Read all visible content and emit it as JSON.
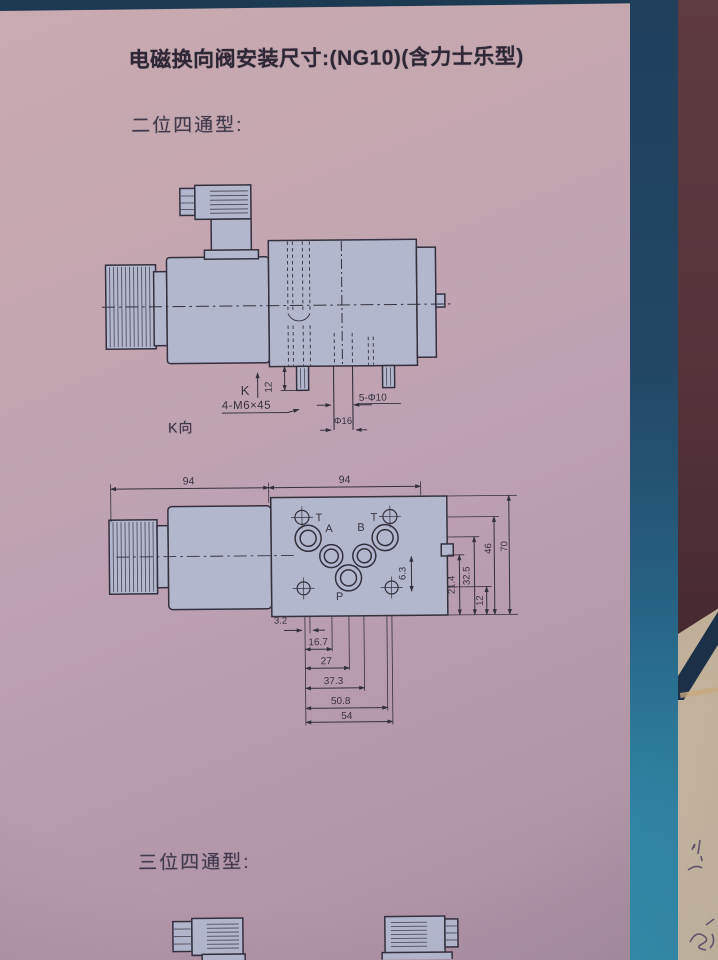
{
  "title": "电磁换向阀安装尺寸:(NG10)(含力士乐型)",
  "section_two_position": "二位四通型:",
  "section_three_position": "三位四通型:",
  "side_view": {
    "view_ref_label": "K向",
    "dims": {
      "k": "K",
      "offset_12": "12",
      "mounting_bolts": "4-M6×45",
      "locating_pins": "5-Φ10",
      "center_hole": "Φ16"
    }
  },
  "top_view": {
    "ports": {
      "t_left": "T",
      "t_right": "T",
      "a": "A",
      "b": "B",
      "p": "P"
    },
    "dims": {
      "width_left": "94",
      "width_right": "94",
      "h_3_2": "3.2",
      "h_16_7": "16.7",
      "h_27": "27",
      "h_37_3": "37.3",
      "h_50_8": "50.8",
      "h_54": "54",
      "v_6_3": "6.3",
      "v_12": "12",
      "v_21_4": "21.4",
      "v_32_5": "32.5",
      "v_46": "46",
      "v_70": "70"
    }
  },
  "colors": {
    "page_pink": "#bda0b2",
    "drawing_fill": "#b3b7cd",
    "drawing_line": "#34303e",
    "top_strip_navy": "#1c3a52",
    "side_strip_teal": "#2f84a4",
    "side_paper_beige": "#c2b098",
    "side_cover_brown": "#57343b"
  }
}
